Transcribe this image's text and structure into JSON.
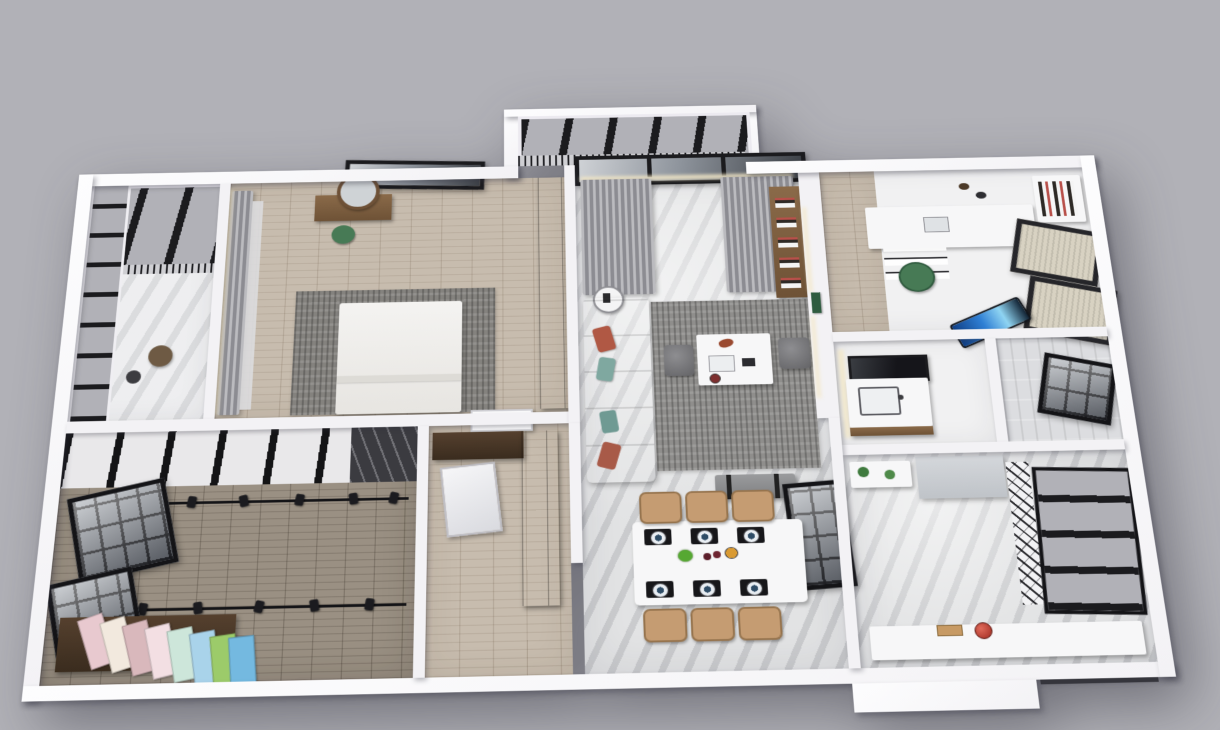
{
  "scene": {
    "kind": "3d-floorplan-render",
    "view": "top-down axonometric cutaway of an apartment",
    "visible_text": "none"
  },
  "background_color": "#b1b1b7",
  "palette": {
    "bg": "#b1b1b7",
    "wall": "#f3f2f5",
    "wall_bright": "#fdfdfe",
    "wall_shadow": "rgba(50,50,62,0.38)",
    "marble": "#d7d8da",
    "marble_light": "#e6e7e9",
    "wood_light": "#c7bcae",
    "wood_brown": "#9a9083",
    "wood_mid": "#7d5f41",
    "wood_dark": "#44false",
    "frame_black": "#1b1b1e",
    "glass_gray": "#b1b1b7",
    "curtain": "#a3a3a7",
    "rug": "#8f8e8c",
    "sofa": "#f1efe9",
    "chair_tan": "#c59c72",
    "chair_green": "#477a55",
    "accent_red": "#b05844",
    "accent_teal": "#7fa8a0",
    "blind": "#d8d2c2",
    "blue_item": "#2f7fd4",
    "glow": "#f3e8c8",
    "plate_navy": "#2e4c66"
  },
  "rack_board_colors": [
    "#e8c9cf",
    "#f2e9de",
    "#d9b8bc",
    "#f3dfe3",
    "#cde6da",
    "#a9d3ea",
    "#9ccb6a",
    "#74b9e0"
  ],
  "rooms": [
    {
      "id": "balcony-top-left",
      "name": "glazed balcony (top-left)",
      "items": [
        "glass roof",
        "glass railing band",
        "marble floor"
      ]
    },
    {
      "id": "master-bedroom",
      "name": "master bedroom",
      "items": [
        "double bed",
        "gray rug",
        "wood vanity with round mirror",
        "green stool",
        "dark wardrobe",
        "curtains",
        "window"
      ]
    },
    {
      "id": "center-balcony",
      "name": "glazed balcony (top-center)",
      "items": [
        "glass roof",
        "railing"
      ]
    },
    {
      "id": "living-room",
      "name": "living room",
      "items": [
        "white sofa with pillows",
        "gray rug",
        "marble coffee table",
        "two ottomans",
        "bench",
        "curtains",
        "wall shelf",
        "side table",
        "media wall"
      ]
    },
    {
      "id": "study",
      "name": "study / kids room",
      "items": [
        "white desk",
        "green chair",
        "bookshelf",
        "roller-blind windows",
        "blue lounger"
      ]
    },
    {
      "id": "bathroom",
      "name": "bathroom",
      "items": [
        "vanity with sink",
        "black framed mirror",
        "backlit wall"
      ]
    },
    {
      "id": "shower-room",
      "name": "shower room",
      "items": [
        "tiled walls",
        "window"
      ]
    },
    {
      "id": "studio",
      "name": "studio / dressing room",
      "items": [
        "track lighting rails",
        "spotlights",
        "color sample rack",
        "grille windows",
        "wood floor",
        "pergola beams"
      ]
    },
    {
      "id": "foyer",
      "name": "foyer",
      "items": [
        "entry door",
        "L-shaped dark wardrobe",
        "leaning mirror"
      ]
    },
    {
      "id": "dining-room",
      "name": "dining area",
      "items": [
        "marble dining table",
        "six place settings",
        "six tan chairs"
      ]
    },
    {
      "id": "kitchen",
      "name": "kitchen",
      "items": [
        "counter run",
        "red pot",
        "refrigerator",
        "open shelves with plants",
        "glass partition",
        "barred windows"
      ]
    }
  ]
}
